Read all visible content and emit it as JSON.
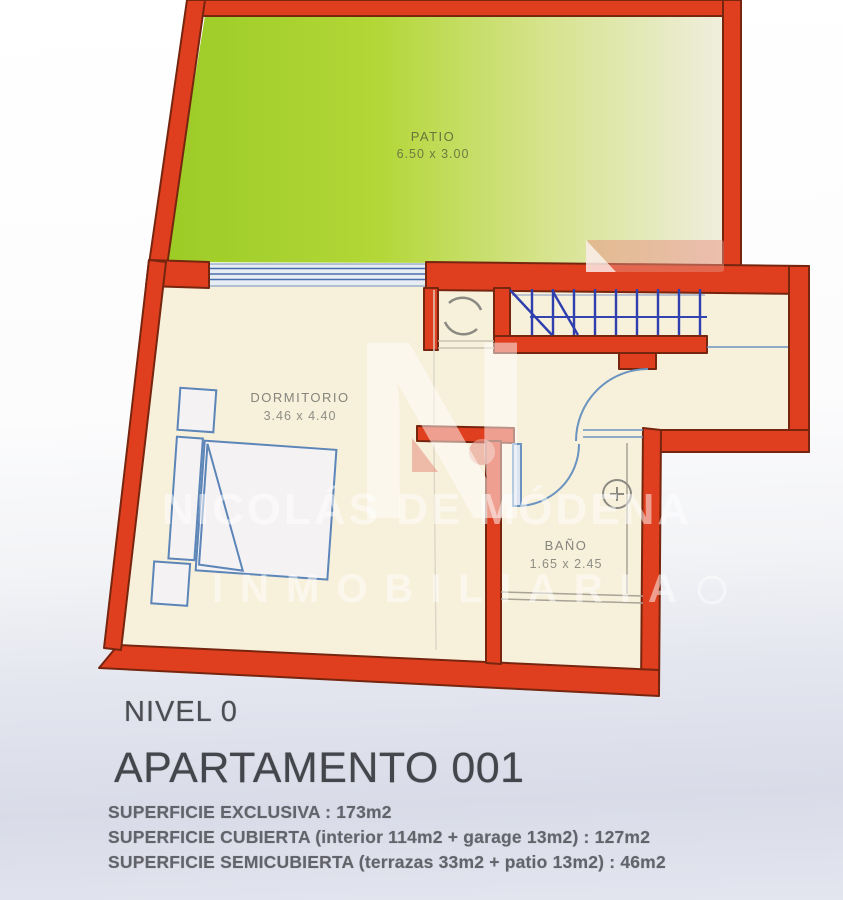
{
  "floorplan": {
    "rooms": {
      "patio": {
        "label": "PATIO",
        "dims": "6.50 x 3.00"
      },
      "dormitorio": {
        "label": "DORMITORIO",
        "dims": "3.46 x 4.40"
      },
      "bano": {
        "label": "BAÑO",
        "dims": "1.65 x 2.45"
      }
    },
    "colors": {
      "wall": "#df3f1e",
      "wall_outline": "#76250f",
      "patio_green": "#9ccb26",
      "floor_cream": "#f7f0db",
      "stair_blue": "#2f3fae",
      "furniture_blue": "#5c85b8"
    }
  },
  "watermark": {
    "logo_letter": "N",
    "line1": "NICOLÁS DE MÓDENA",
    "line2": "INMOBILIARIA"
  },
  "footer": {
    "level": "NIVEL 0",
    "title": "APARTAMENTO 001",
    "surfaces": [
      "SUPERFICIE EXCLUSIVA : 173m2",
      "SUPERFICIE CUBIERTA (interior 114m2 + garage 13m2) : 127m2",
      "SUPERFICIE SEMICUBIERTA (terrazas 33m2 + patio 13m2) : 46m2"
    ]
  }
}
